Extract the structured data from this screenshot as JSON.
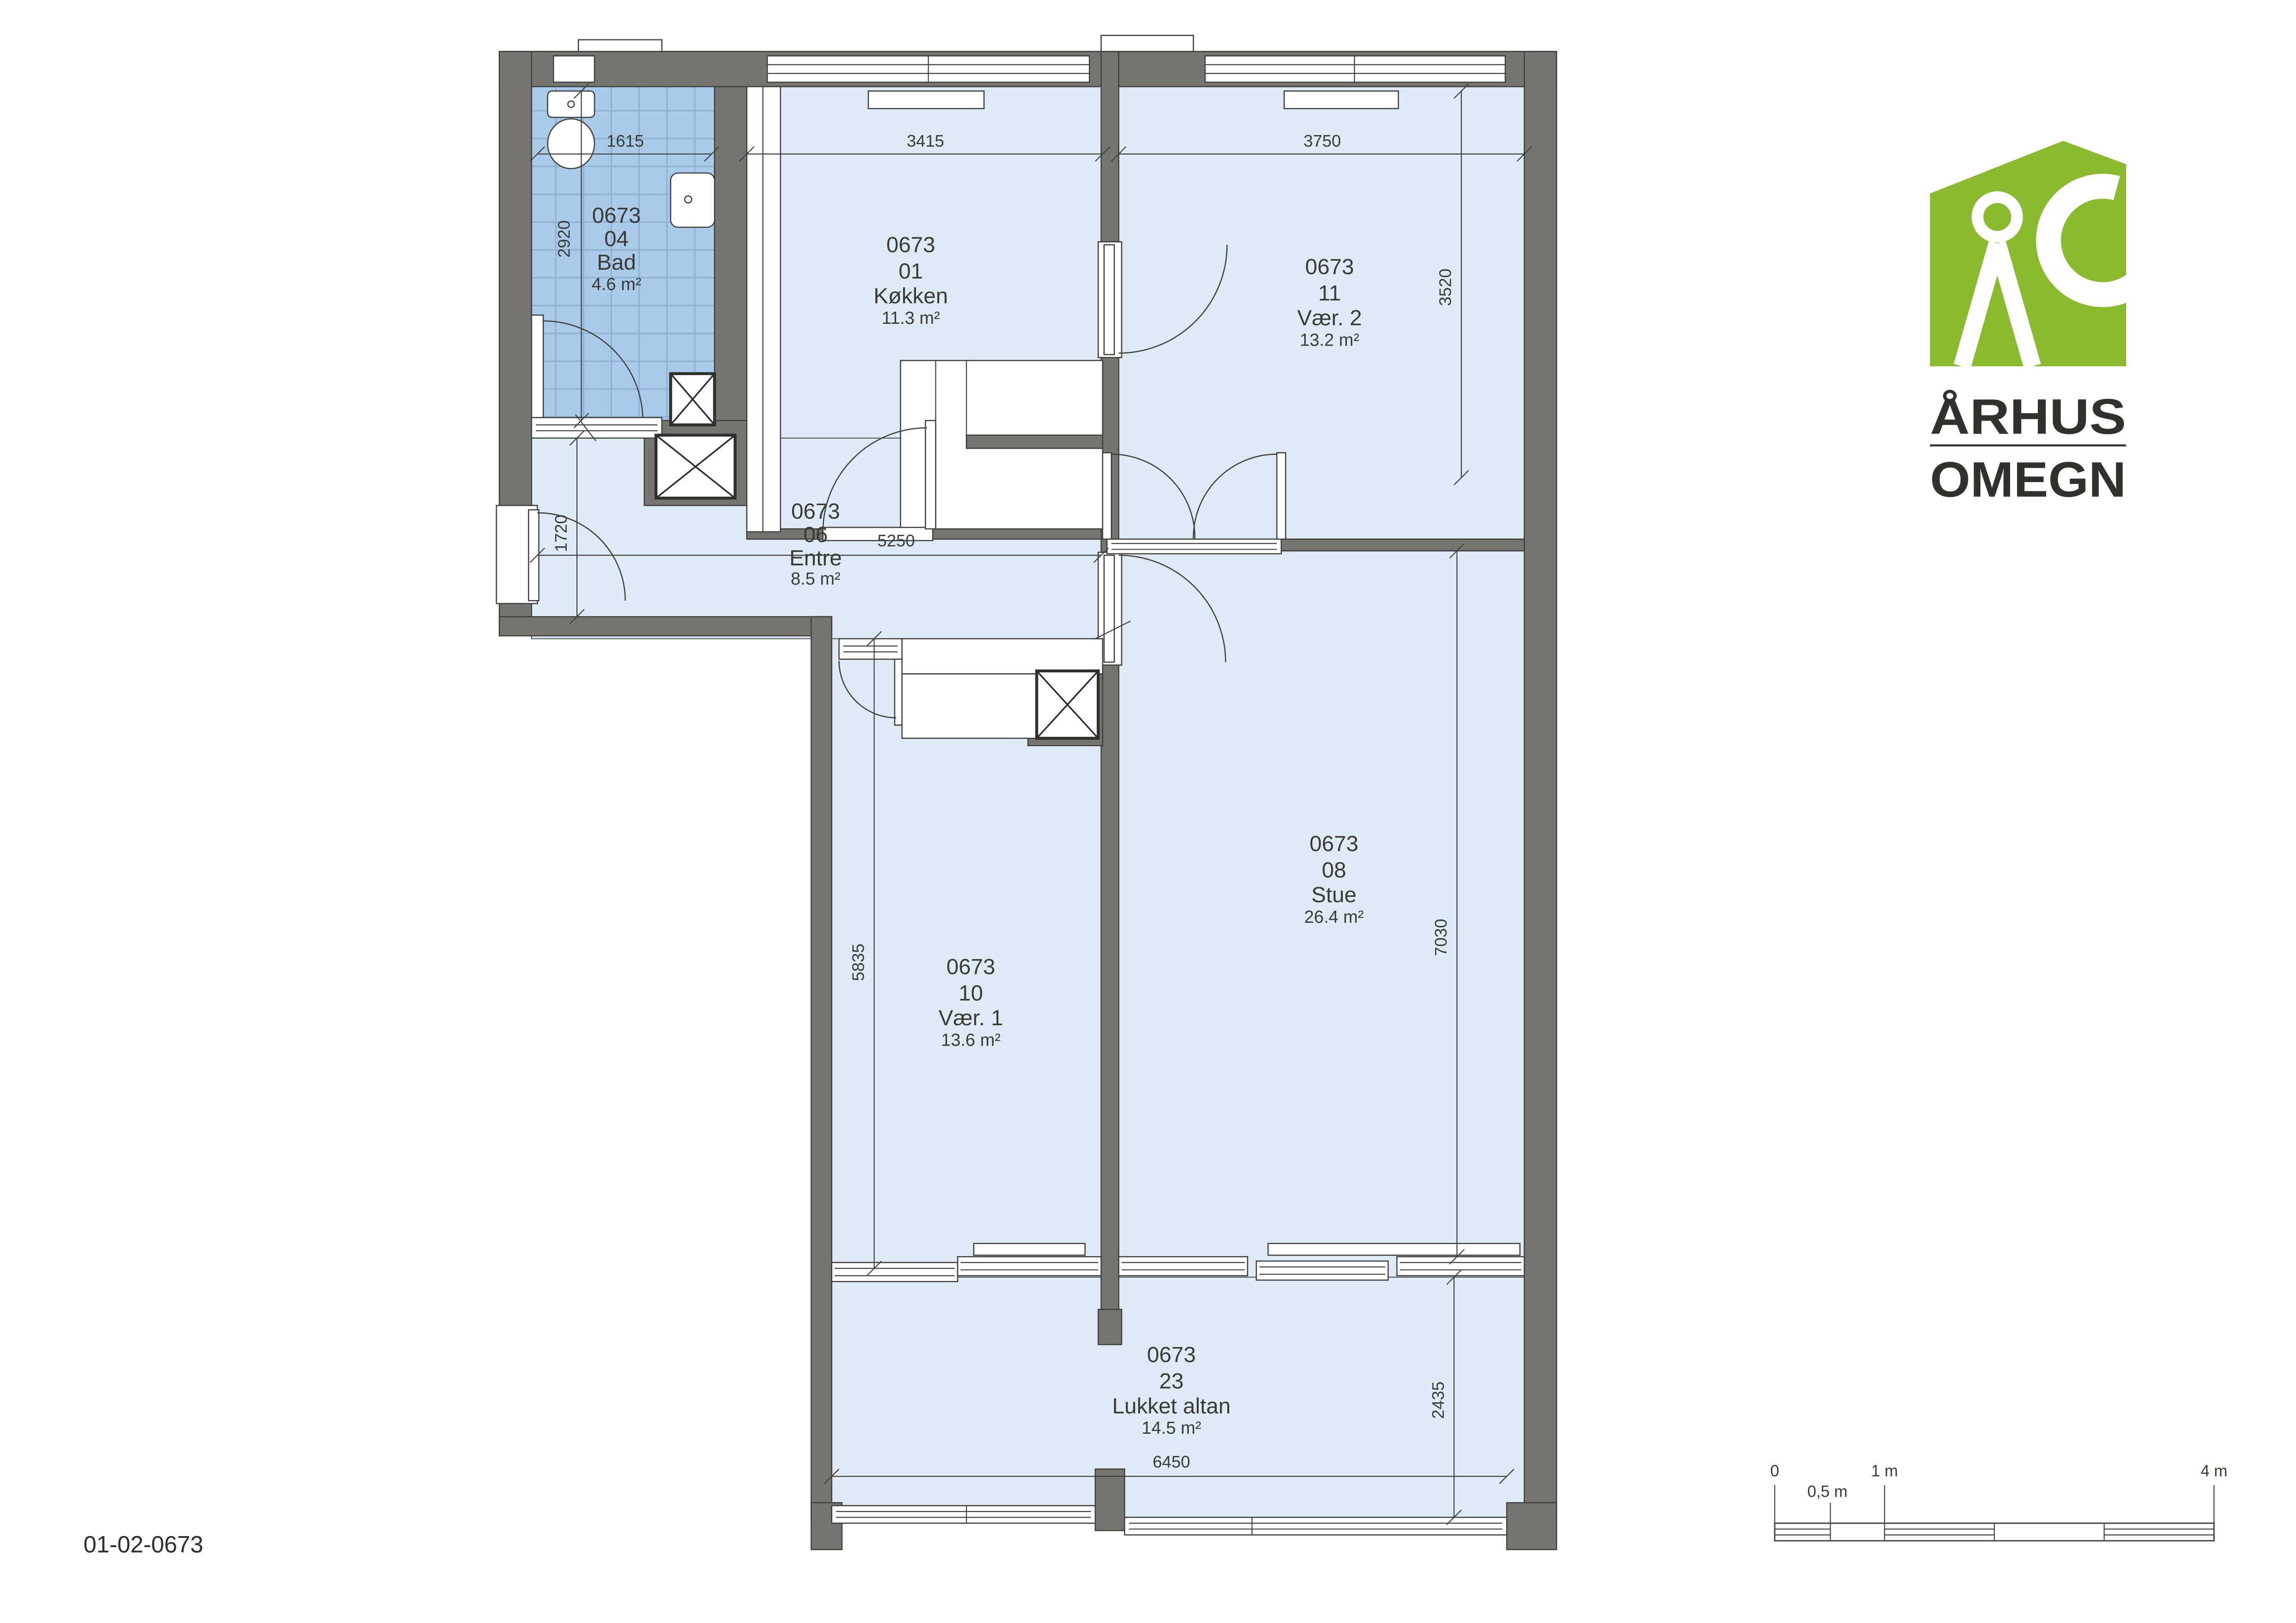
{
  "drawing": {
    "number": "01-02-0673"
  },
  "logo": {
    "name_line1": "ÅRHUS",
    "name_line2": "OMEGN",
    "green": "#8BBA31"
  },
  "rooms": [
    {
      "id": "0673",
      "number": "04",
      "name": "Bad",
      "area": "4.6 m²"
    },
    {
      "id": "0673",
      "number": "01",
      "name": "Køkken",
      "area": "11.3 m²"
    },
    {
      "id": "0673",
      "number": "11",
      "name": "Vær. 2",
      "area": "13.2 m²"
    },
    {
      "id": "0673",
      "number": "06",
      "name": "Entre",
      "area": "8.5 m²"
    },
    {
      "id": "0673",
      "number": "08",
      "name": "Stue",
      "area": "26.4 m²"
    },
    {
      "id": "0673",
      "number": "10",
      "name": "Vær. 1",
      "area": "13.6 m²"
    },
    {
      "id": "0673",
      "number": "23",
      "name": "Lukket altan",
      "area": "14.5 m²"
    }
  ],
  "dimensions_mm": [
    {
      "value": "1615"
    },
    {
      "value": "2920"
    },
    {
      "value": "3415"
    },
    {
      "value": "3750"
    },
    {
      "value": "3520"
    },
    {
      "value": "1720"
    },
    {
      "value": "5250"
    },
    {
      "value": "5835"
    },
    {
      "value": "7030"
    },
    {
      "value": "2435"
    },
    {
      "value": "6450"
    }
  ],
  "scale_bar": {
    "tick_0": "0",
    "tick_05": "0,5 m",
    "tick_1": "1 m",
    "tick_4": "4 m"
  },
  "colors": {
    "wall": "#76756F",
    "room_fill": "#DEEBF7",
    "tile_fill": "#A9CBE9",
    "logo_green": "#8BBA31",
    "ink": "#3F3F3C"
  }
}
